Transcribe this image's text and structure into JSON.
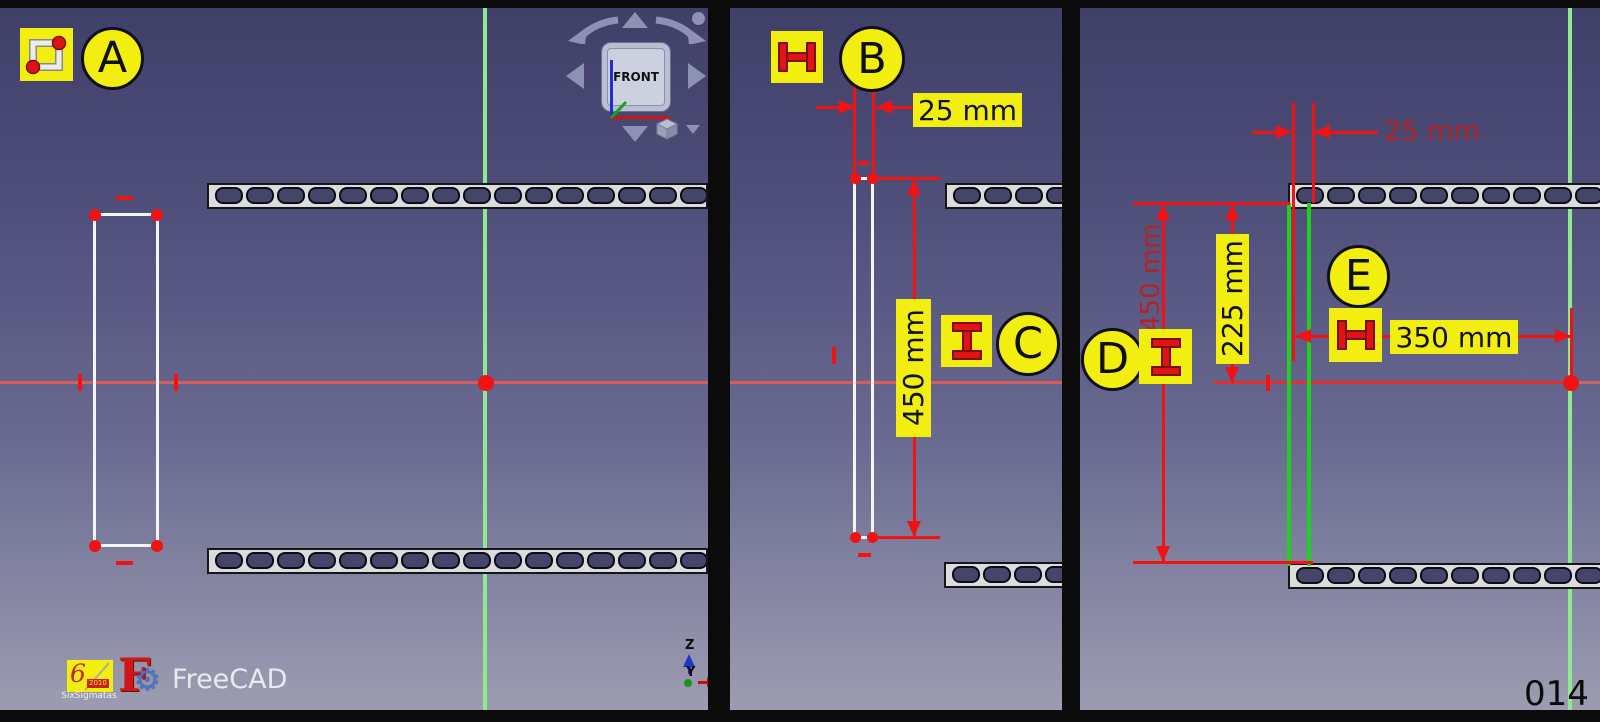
{
  "steps": {
    "a": "A",
    "b": "B",
    "c": "C",
    "d": "D",
    "e": "E"
  },
  "tools": {
    "rectangle": "rectangle-sketch-tool",
    "horizontal_distance": "horizontal-distance-constraint",
    "vertical_distance": "vertical-distance-constraint"
  },
  "dimensions": {
    "p2_width": "25 mm",
    "p2_height": "450 mm",
    "p3_width": "25 mm",
    "p3_height": "450 mm",
    "p3_offset": "225 mm",
    "p3_distance": "350 mm"
  },
  "navcube": {
    "front": "FRONT"
  },
  "triad": {
    "x": "X",
    "y": "Y",
    "z": "Z"
  },
  "branding": {
    "app": "FreeCAD",
    "watermark": "SixSigmatas",
    "watermark_year": "2010"
  },
  "page_number": "014",
  "colors": {
    "annotation_yellow": "#f2ee10",
    "dimension_red": "#f21212",
    "dimension_darkred": "#b22424",
    "sketch_white": "#f5f5f5",
    "sketch_green": "#1ed11e",
    "axis_red": "#d95c5c",
    "axis_green": "#8fe98f",
    "background_top": "#3f3f68",
    "background_bottom": "#9c9cb1"
  }
}
